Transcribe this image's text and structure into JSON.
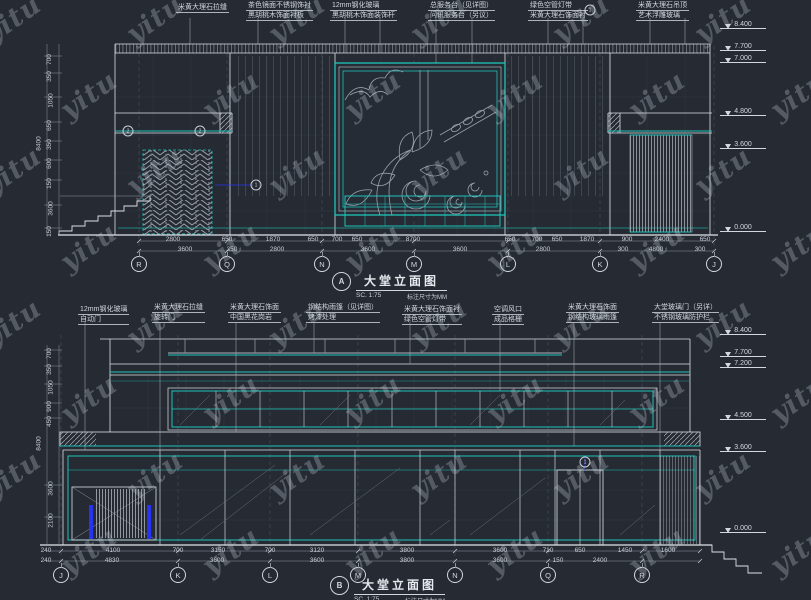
{
  "watermark": {
    "text": "yitu"
  },
  "colors": {
    "background": "#252a33",
    "line_white": "#dde2e8",
    "line_gray": "#8f96a0",
    "accent_cyan": "#1fc4b9",
    "accent_blue": "#2733f0",
    "text": "#d3d8de"
  },
  "top": {
    "title": {
      "bubble": "A",
      "label": "大堂立面图",
      "scale": "SC. 1:75",
      "note": "标注尺寸为MM"
    },
    "annotations": [
      {
        "l1": "米黄大理石拉缝",
        "l2": "",
        "x": 176,
        "y": 3
      },
      {
        "l1": "茶色镜面不锈钢饰衬",
        "l2": "黑胡桃木饰面衬板",
        "x": 246,
        "y": 1
      },
      {
        "l1": "12mm钢化玻璃",
        "l2": "黑胡桃木饰面装饰杆",
        "x": 330,
        "y": 1
      },
      {
        "l1": "总服务台（见详图）",
        "l2": "问讯服务台（另议）",
        "x": 428,
        "y": 1
      },
      {
        "l1": "绿色空管灯带",
        "l2": "米黄大理石饰面衬",
        "x": 528,
        "y": 1
      },
      {
        "l1": "米黄大理石吊顶",
        "l2": "艺术浮雕玻璃",
        "x": 636,
        "y": 1
      }
    ],
    "grid_bubbles": [
      {
        "t": "R",
        "x": 139
      },
      {
        "t": "Q",
        "x": 227
      },
      {
        "t": "N",
        "x": 322
      },
      {
        "t": "M",
        "x": 414
      },
      {
        "t": "L",
        "x": 508
      },
      {
        "t": "K",
        "x": 600
      },
      {
        "t": "J",
        "x": 714
      }
    ],
    "dims_row1": [
      {
        "t": "2800",
        "x": 173
      },
      {
        "t": "650",
        "x": 227
      },
      {
        "t": "1870",
        "x": 273
      },
      {
        "t": "650",
        "x": 313
      },
      {
        "t": "700",
        "x": 337
      },
      {
        "t": "650",
        "x": 357
      },
      {
        "t": "8700",
        "x": 413
      },
      {
        "t": "650",
        "x": 510
      },
      {
        "t": "700",
        "x": 537
      },
      {
        "t": "650",
        "x": 557
      },
      {
        "t": "1870",
        "x": 587
      },
      {
        "t": "900",
        "x": 627
      },
      {
        "t": "2400",
        "x": 662
      },
      {
        "t": "650",
        "x": 705
      }
    ],
    "dims_row2": [
      {
        "t": "3600",
        "x": 185
      },
      {
        "t": "350",
        "x": 232
      },
      {
        "t": "2800",
        "x": 277
      },
      {
        "t": "3600",
        "x": 368
      },
      {
        "t": "3600",
        "x": 460
      },
      {
        "t": "2800",
        "x": 543
      },
      {
        "t": "300",
        "x": 623
      },
      {
        "t": "4800",
        "x": 656
      },
      {
        "t": "300",
        "x": 700
      }
    ],
    "left_dims": [
      {
        "t": "700",
        "y": 56
      },
      {
        "t": "350",
        "y": 73
      },
      {
        "t": "1050",
        "y": 97
      },
      {
        "t": "650",
        "y": 122
      },
      {
        "t": "350",
        "y": 141
      },
      {
        "t": "600",
        "y": 160
      },
      {
        "t": "150",
        "y": 180
      },
      {
        "t": "3600",
        "y": 205
      },
      {
        "t": "150",
        "y": 228
      },
      {
        "t": "8400",
        "x": 32,
        "y": 140
      }
    ],
    "levels": [
      {
        "t": "8.400",
        "y": 30
      },
      {
        "t": "7.700",
        "y": 52
      },
      {
        "t": "7.000",
        "y": 64
      },
      {
        "t": "4.800",
        "y": 117
      },
      {
        "t": "3.600",
        "y": 150
      },
      {
        "t": "0.000",
        "y": 233
      }
    ],
    "detail_markers": [
      {
        "t": "2",
        "x": 128,
        "y": 131
      },
      {
        "t": "2",
        "x": 200,
        "y": 131
      },
      {
        "t": "1",
        "x": 590,
        "y": 10
      },
      {
        "t": "1",
        "x": 256,
        "y": 185
      }
    ]
  },
  "bottom": {
    "title": {
      "bubble": "B",
      "label": "大堂立面图",
      "scale": "SC. 1:75",
      "note": "标注尺寸为MM"
    },
    "annotations": [
      {
        "l1": "12mm钢化玻璃",
        "l2": "自动门",
        "x": 78,
        "y": 305
      },
      {
        "l1": "米黄大理石拉缝",
        "l2": "旋转门",
        "x": 152,
        "y": 303
      },
      {
        "l1": "米黄大理石饰面",
        "l2": "中国黑花岗岩",
        "x": 228,
        "y": 303
      },
      {
        "l1": "钢结构雨篷（见详图）",
        "l2": "烤漆处理",
        "x": 306,
        "y": 303
      },
      {
        "l1": "米黄大理石饰面衬",
        "l2": "绿色空管灯带",
        "x": 402,
        "y": 305
      },
      {
        "l1": "空调风口",
        "l2": "成品格栅",
        "x": 492,
        "y": 305
      },
      {
        "l1": "米黄大理石饰面",
        "l2": "钢结构玻璃雨篷",
        "x": 566,
        "y": 303
      },
      {
        "l1": "大堂玻璃门（另详）",
        "l2": "不锈钢玻璃防护栏",
        "x": 652,
        "y": 303
      }
    ],
    "grid_bubbles": [
      {
        "t": "J",
        "x": 61
      },
      {
        "t": "K",
        "x": 178
      },
      {
        "t": "L",
        "x": 270
      },
      {
        "t": "M",
        "x": 358
      },
      {
        "t": "N",
        "x": 455
      },
      {
        "t": "Q",
        "x": 548
      },
      {
        "t": "R",
        "x": 642
      }
    ],
    "dims_row1": [
      {
        "t": "240",
        "x": 46
      },
      {
        "t": "4100",
        "x": 113
      },
      {
        "t": "700",
        "x": 178
      },
      {
        "t": "3150",
        "x": 218
      },
      {
        "t": "700",
        "x": 270
      },
      {
        "t": "3120",
        "x": 317
      },
      {
        "t": "3800",
        "x": 407
      },
      {
        "t": "3600",
        "x": 500
      },
      {
        "t": "710",
        "x": 548
      },
      {
        "t": "650",
        "x": 580
      },
      {
        "t": "1450",
        "x": 625
      },
      {
        "t": "1600",
        "x": 668
      }
    ],
    "dims_row2": [
      {
        "t": "240",
        "x": 46
      },
      {
        "t": "4830",
        "x": 112
      },
      {
        "t": "3600",
        "x": 217
      },
      {
        "t": "3600",
        "x": 317
      },
      {
        "t": "3800",
        "x": 407
      },
      {
        "t": "3600",
        "x": 500
      },
      {
        "t": "150",
        "x": 558
      },
      {
        "t": "2400",
        "x": 600
      }
    ],
    "left_dims": [
      {
        "t": "700",
        "y": 350
      },
      {
        "t": "350",
        "y": 366
      },
      {
        "t": "1050",
        "y": 384
      },
      {
        "t": "900",
        "y": 403
      },
      {
        "t": "450",
        "y": 418
      },
      {
        "t": "3600",
        "y": 485
      },
      {
        "t": "2100",
        "y": 517
      },
      {
        "t": "8400",
        "x": 32,
        "y": 440
      }
    ],
    "levels": [
      {
        "t": "8.400",
        "y": 336
      },
      {
        "t": "7.700",
        "y": 358
      },
      {
        "t": "7.200",
        "y": 369
      },
      {
        "t": "4.500",
        "y": 421
      },
      {
        "t": "3.600",
        "y": 453
      },
      {
        "t": "0.000",
        "y": 534
      }
    ],
    "detail_markers": [
      {
        "t": "1",
        "x": 585,
        "y": 462
      }
    ]
  }
}
